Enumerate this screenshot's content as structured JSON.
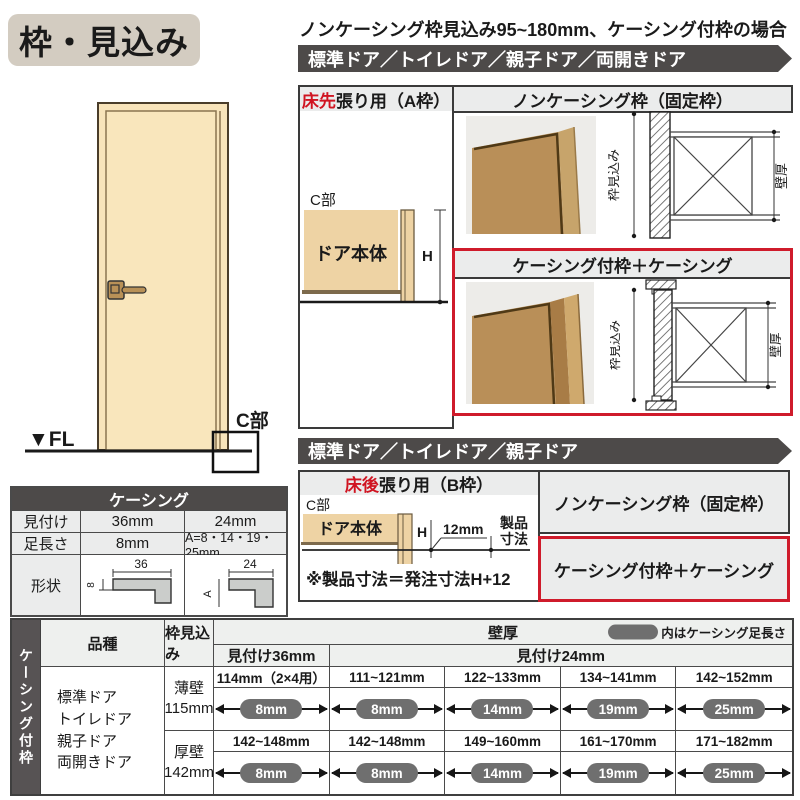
{
  "colors": {
    "accent_red": "#cf1b2b",
    "banner_gray": "#4d4a49",
    "header_gray": "#ebecec",
    "wood_tan": "#eed3a4",
    "photo_wood": "#b98f58",
    "pill_gray": "#6f6f6f",
    "title_beige": "#d3ccc1"
  },
  "title": "枠・見込み",
  "top_note": "ノンケーシング枠見込み95~180mm、ケーシング付枠の場合",
  "door_figure": {
    "fl_label": "▼FL",
    "c_label": "C部"
  },
  "section_a": {
    "banner": "標準ドア／トイレドア／親子ドア／両開きドア",
    "frame_label_red": "床先",
    "frame_label_rest": "張り用（A枠）",
    "c_label": "C部",
    "door_body": "ドア本体",
    "h_label": "H",
    "noncasing_header": "ノンケーシング枠（固定枠）",
    "casing_header": "ケーシング付枠＋ケーシング",
    "dim_frame": "枠見込み",
    "dim_wall": "壁厚"
  },
  "section_b": {
    "banner": "標準ドア／トイレドア／親子ドア",
    "frame_label_red": "床後",
    "frame_label_rest": "張り用（B枠）",
    "c_label": "C部",
    "door_body": "ドア本体",
    "h_label": "H",
    "dim_12": "12mm",
    "product_dim_l1": "製品",
    "product_dim_l2": "寸法",
    "note": "※製品寸法＝発注寸法H+12",
    "noncasing_label": "ノンケーシング枠（固定枠）",
    "casing_label": "ケーシング付枠＋ケーシング",
    "dim_frame": "枠見込み",
    "dim_wall": "壁厚"
  },
  "casing_table": {
    "title": "ケーシング",
    "row1": {
      "label": "見付け",
      "col36": "36mm",
      "col24": "24mm"
    },
    "row2": {
      "label": "足長さ",
      "col36": "8mm",
      "col24": "A=8・14・19・25mm"
    },
    "row3": {
      "label": "形状"
    },
    "shape36": {
      "top": "36",
      "side": "8"
    },
    "shape24": {
      "top": "24",
      "side": "A"
    }
  },
  "bottom_table": {
    "side_label": "ケーシング付枠",
    "col_kind": "品種",
    "col_frame_depth": "枠見込み",
    "col_wall": "壁厚",
    "legend": "内はケーシング足長さ",
    "sub36": "見付け36mm",
    "sub24": "見付け24mm",
    "kinds": [
      "標準ドア",
      "トイレドア",
      "親子ドア",
      "両開きドア"
    ],
    "rows": [
      {
        "depth_line1": "薄壁",
        "depth_line2": "115mm",
        "cells": [
          {
            "range": "114mm（2×4用）",
            "pill": "8mm"
          },
          {
            "range": "111~121mm",
            "pill": "8mm"
          },
          {
            "range": "122~133mm",
            "pill": "14mm"
          },
          {
            "range": "134~141mm",
            "pill": "19mm"
          },
          {
            "range": "142~152mm",
            "pill": "25mm"
          }
        ]
      },
      {
        "depth_line1": "厚壁",
        "depth_line2": "142mm",
        "cells": [
          {
            "range": "142~148mm",
            "pill": "8mm"
          },
          {
            "range": "142~148mm",
            "pill": "8mm"
          },
          {
            "range": "149~160mm",
            "pill": "14mm"
          },
          {
            "range": "161~170mm",
            "pill": "19mm"
          },
          {
            "range": "171~182mm",
            "pill": "25mm"
          }
        ]
      }
    ]
  }
}
